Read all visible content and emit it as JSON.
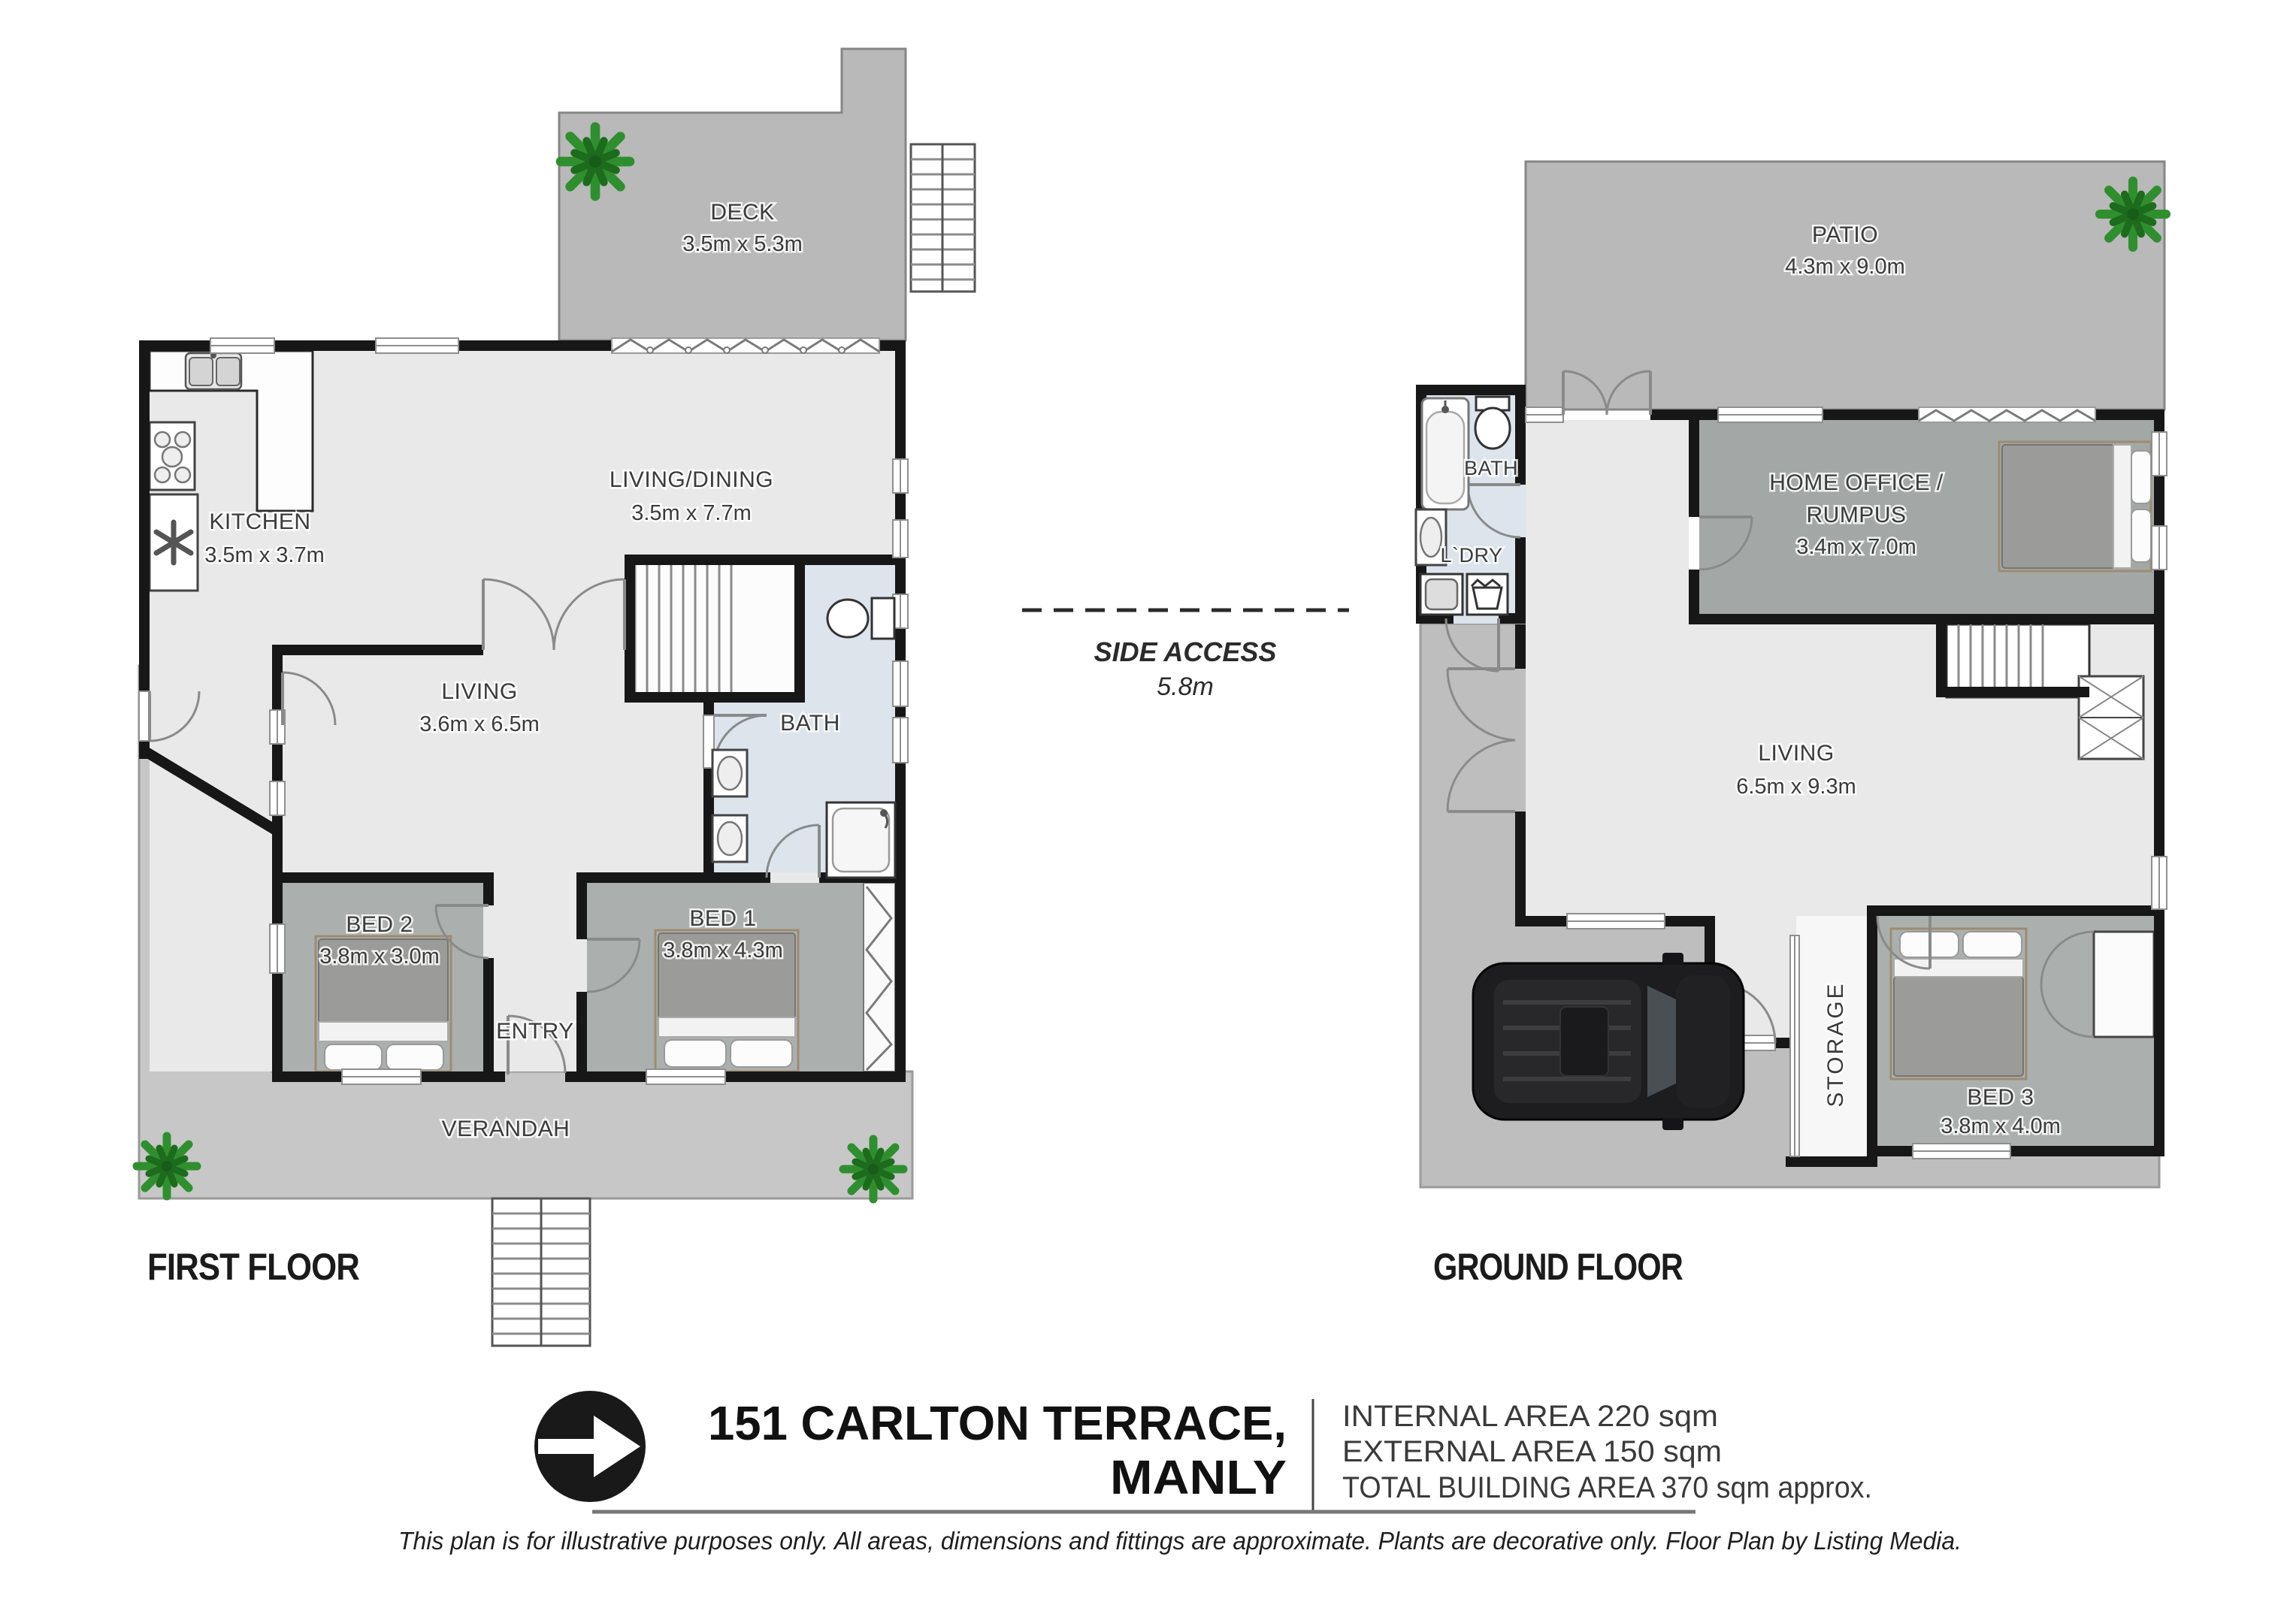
{
  "first_floor": {
    "title": "FIRST FLOOR",
    "deck": {
      "name": "DECK",
      "dims": "3.5m x 5.3m"
    },
    "living_dining": {
      "name": "LIVING/DINING",
      "dims": "3.5m x 7.7m"
    },
    "kitchen": {
      "name": "KITCHEN",
      "dims": "3.5m x 3.7m"
    },
    "living": {
      "name": "LIVING",
      "dims": "3.6m x 6.5m"
    },
    "bath": {
      "name": "BATH"
    },
    "bed2": {
      "name": "BED 2",
      "dims": "3.8m x 3.0m"
    },
    "bed1": {
      "name": "BED 1",
      "dims": "3.8m x 4.3m"
    },
    "entry": {
      "name": "ENTRY"
    },
    "verandah": {
      "name": "VERANDAH"
    }
  },
  "ground_floor": {
    "title": "GROUND FLOOR",
    "patio": {
      "name": "PATIO",
      "dims": "4.3m x 9.0m"
    },
    "bath": {
      "name": "BATH"
    },
    "laundry": {
      "name": "L`DRY"
    },
    "home_office": {
      "name_line1": "HOME OFFICE /",
      "name_line2": "RUMPUS",
      "dims": "3.4m x 7.0m"
    },
    "living": {
      "name": "LIVING",
      "dims": "6.5m x 9.3m"
    },
    "storage": {
      "name": "STORAGE"
    },
    "bed3": {
      "name": "BED 3",
      "dims": "3.8m x 4.0m"
    }
  },
  "side_access": {
    "label": "SIDE ACCESS",
    "dims": "5.8m"
  },
  "footer": {
    "address_line1": "151 CARLTON TERRACE,",
    "address_line2": "MANLY",
    "internal_area": "INTERNAL AREA 220 sqm",
    "external_area": "EXTERNAL AREA 150 sqm",
    "total_area": "TOTAL BUILDING AREA 370 sqm approx.",
    "disclaimer": "This plan is for illustrative purposes only. All areas, dimensions and fittings are approximate. Plants are decorative only. Floor Plan by Listing Media."
  },
  "colors": {
    "wall": "#171717",
    "outdoor_deck": "#b8b9b8",
    "verandah": "#c6c7c6",
    "interior": "#e8e9e8",
    "bedroom": "#abb0ae",
    "bath_floor": "#dde4ec",
    "plant_green": "#2f8f2f",
    "logo_black": "#191919"
  }
}
